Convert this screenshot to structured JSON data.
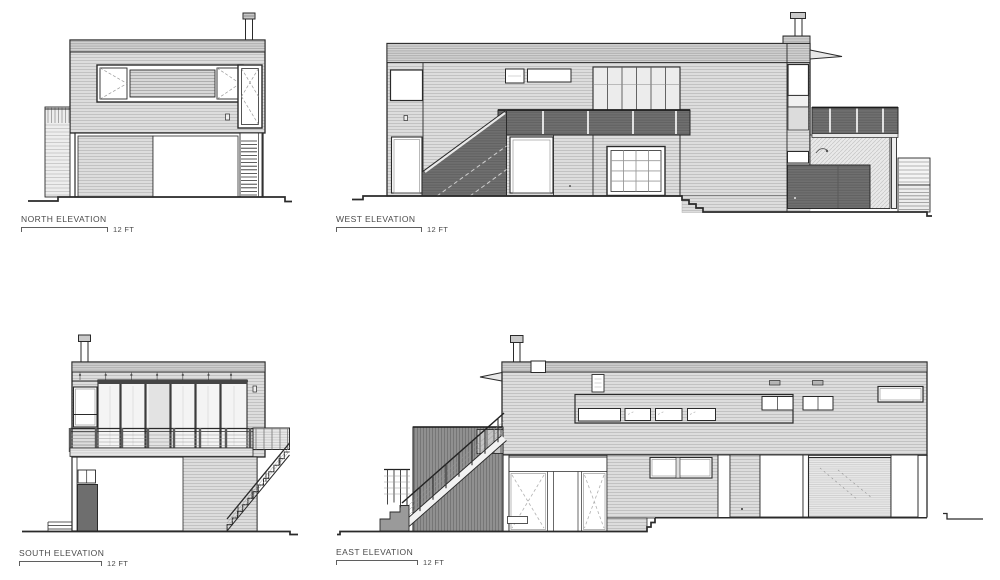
{
  "drawing": {
    "type": "architectural-elevation-sheet",
    "sheet_background": "#ffffff",
    "ink_color": "#2a2a2a",
    "siding_color": "#dddddd",
    "dark_fill_color": "#6f6f6f",
    "screen_fill_color": "#909090",
    "elevations": [
      {
        "id": "north",
        "label": "NORTH ELEVATION",
        "scale_label": "12 FT"
      },
      {
        "id": "west",
        "label": "WEST ELEVATION",
        "scale_label": "12 FT"
      },
      {
        "id": "south",
        "label": "SOUTH ELEVATION",
        "scale_label": "12 FT"
      },
      {
        "id": "east",
        "label": "EAST ELEVATION",
        "scale_label": "12 FT"
      }
    ]
  }
}
